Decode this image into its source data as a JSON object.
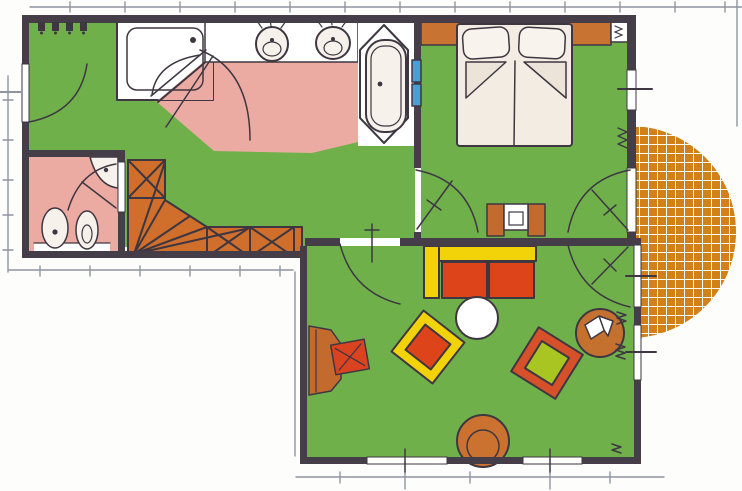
{
  "palette": {
    "background": "#fdfdfb",
    "floor_green": "#6fb04a",
    "bath_pink": "#ecaba2",
    "wall_dark": "#453d48",
    "ink": "#3e3742",
    "line_gray": "#9094a0",
    "stair_orange": "#d06f2c",
    "terrace_orange": "#d28018",
    "terrace_grid_line": "#ffffff",
    "headboard_orange": "#c87331",
    "bed_white": "#f2ece3",
    "pillow_white": "#f8f4ed",
    "fixture_white": "#f6f1ea",
    "radiator_blue": "#4aa0d6",
    "sofa_yellow": "#f2d309",
    "cushion_red": "#dd4419",
    "armchair_frame_red": "#d6502a",
    "armchair_cushion_green": "#a9c522",
    "furniture_brown": "#c36a2f",
    "chair_red": "#d9431f",
    "pouf_brown": "#cb7231",
    "readingchair_brown": "#c4702f",
    "pure_white": "#ffffff"
  },
  "plan": {
    "type": "apartment-floor-plan",
    "rooms": [
      {
        "name": "entrance-hall",
        "floor": "green"
      },
      {
        "name": "bathroom",
        "floor": "pink",
        "fixtures": [
          "shower",
          "double-washbasin",
          "bathtub",
          "towel-radiator"
        ]
      },
      {
        "name": "wc",
        "floor": "pink",
        "fixtures": [
          "corner-sink",
          "toilet",
          "bidet"
        ]
      },
      {
        "name": "staircase",
        "floor": "orange",
        "style": "winder-stairs-with-x-treads"
      },
      {
        "name": "bedroom",
        "floor": "green",
        "furniture": [
          "double-bed",
          "headboard-shelf",
          "dressing-table",
          "radiator"
        ]
      },
      {
        "name": "living-room",
        "floor": "green",
        "furniture": [
          "sofa",
          "coffee-table",
          "armchair-red-cushion",
          "armchair-green-cushion",
          "reading-chair",
          "desk",
          "desk-chair",
          "round-pouf"
        ]
      },
      {
        "name": "terrace",
        "floor": "orange-tile-grid",
        "shape": "semicircle"
      }
    ],
    "doors": [
      "entry-door",
      "bathroom-door",
      "shower-door",
      "wc-door",
      "bedroom-door",
      "living-room-door",
      "bedroom-terrace-door",
      "living-terrace-door"
    ],
    "windows": [
      "bedroom-right-window",
      "living-right-window",
      "living-bottom-window-left",
      "living-bottom-window-right"
    ]
  }
}
